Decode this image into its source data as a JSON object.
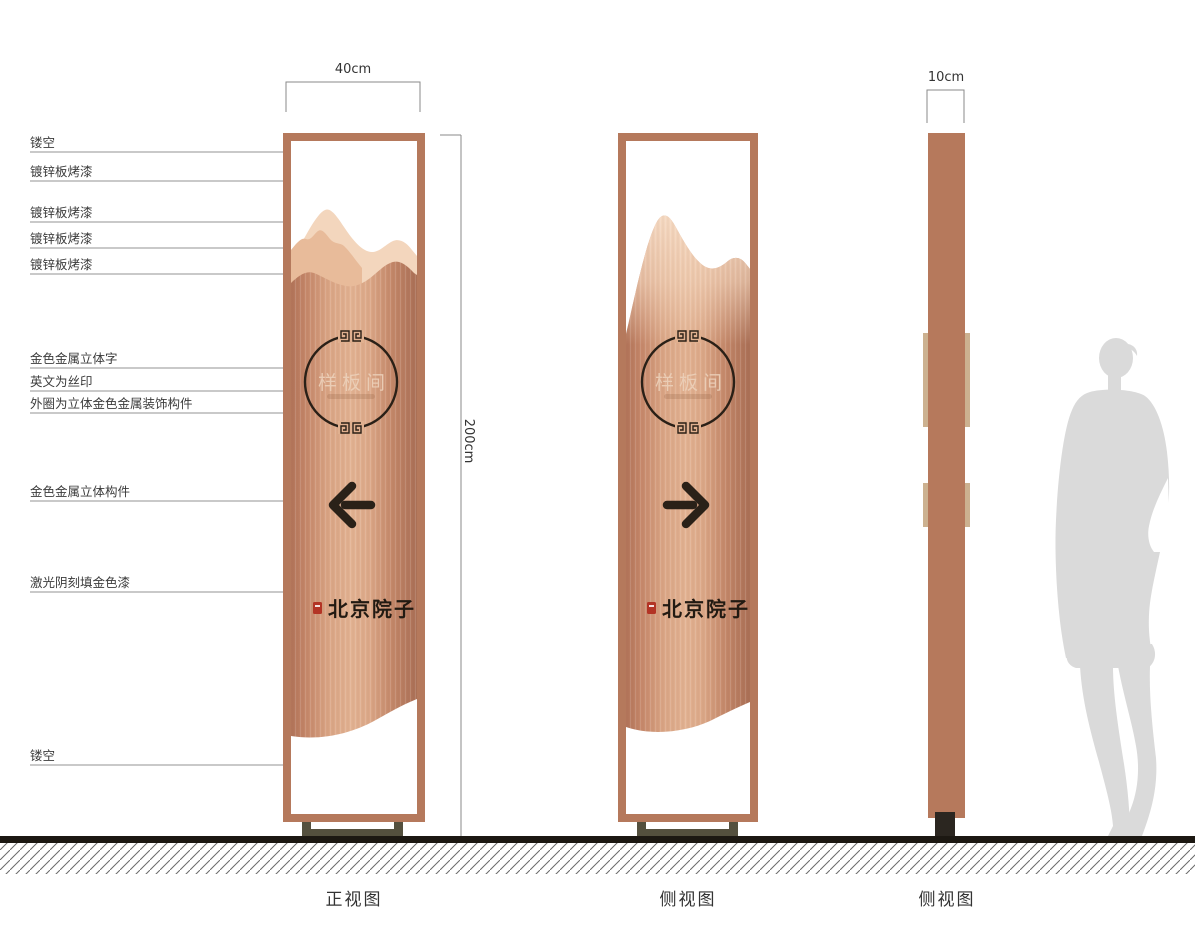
{
  "annotations": {
    "items": [
      {
        "label": "镂空"
      },
      {
        "label": "镀锌板烤漆"
      },
      {
        "label": "镀锌板烤漆"
      },
      {
        "label": "镀锌板烤漆"
      },
      {
        "label": "镀锌板烤漆"
      },
      {
        "label": "金色金属立体字"
      },
      {
        "label": "英文为丝印"
      },
      {
        "label": "外圈为立体金色金属装饰构件"
      },
      {
        "label": "金色金属立体构件"
      },
      {
        "label": "激光阴刻填金色漆"
      },
      {
        "label": "镂空"
      }
    ]
  },
  "dimensions": {
    "front_width": "40cm",
    "height": "200cm",
    "side_width": "10cm"
  },
  "signage": {
    "room_name": "样板间",
    "brand_name": "北京院子"
  },
  "view_labels": {
    "front": "正视图",
    "side": "侧视图",
    "profile": "侧视图"
  },
  "icons": {
    "front_arrow": "arrow-left",
    "side_arrow": "arrow-right",
    "circle_ornament": "chinese-fret-ring",
    "seal": "red-seal-stamp"
  },
  "colors": {
    "frame_copper": "#b5795c",
    "panel_copper_mid": "#e2b292",
    "mountain_light": "#f3d6bd",
    "dark_accent": "#2a2118",
    "seal_red": "#b33425",
    "base_foot": "#54503e",
    "silhouette_gray": "#dadada"
  }
}
